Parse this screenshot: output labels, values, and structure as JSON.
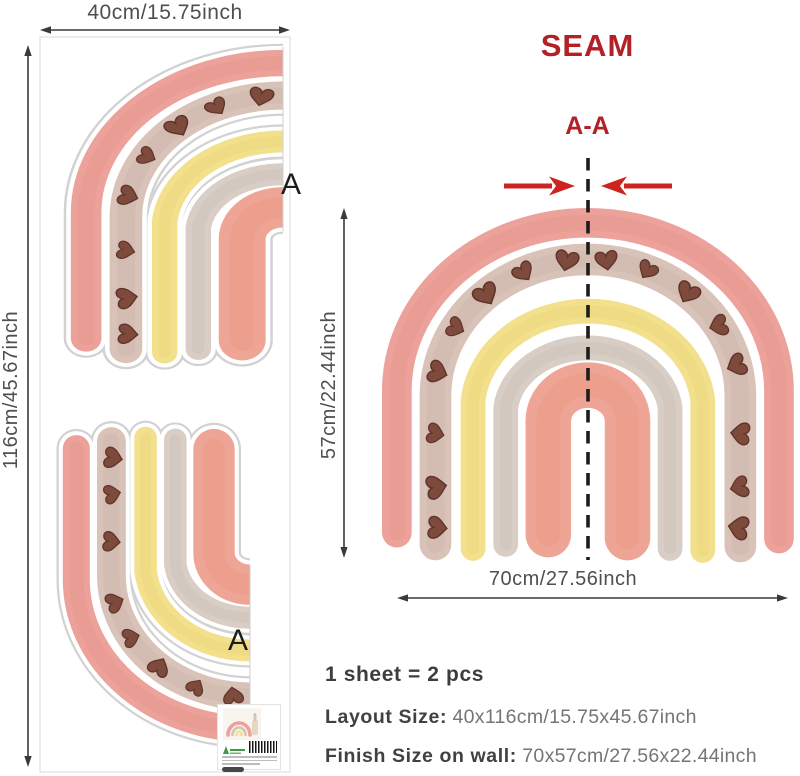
{
  "sheet_panel": {
    "width_label": "40cm/15.75inch",
    "height_label": "116cm/45.67inch",
    "piece_top_label": "A",
    "piece_bottom_label": "A"
  },
  "seam_panel": {
    "title": "SEAM",
    "section_label": "A-A",
    "height_label": "57cm/22.44inch",
    "width_label": "70cm/27.56inch"
  },
  "specs": {
    "pieces_line": "1 sheet = 2 pcs",
    "layout_label": "Layout Size:",
    "layout_value": "40x116cm/15.75x45.67inch",
    "finish_label": "Finish Size on wall:",
    "finish_value": "70x57cm/27.56x22.44inch"
  },
  "palette": {
    "seam_red": "#b32025",
    "arrow_red": "#cd2420",
    "dim_text": "#4f4f4f",
    "dim_line": "#3a3a3a",
    "band_outer_pink": "#eca29a",
    "band_taupe": "#d9c3b9",
    "band_yellow": "#f2e08d",
    "band_gray": "#d8cec6",
    "band_inner_pink": "#efa595",
    "heart_brown": "#7d4a3c",
    "heart_outline": "#5e342a"
  }
}
